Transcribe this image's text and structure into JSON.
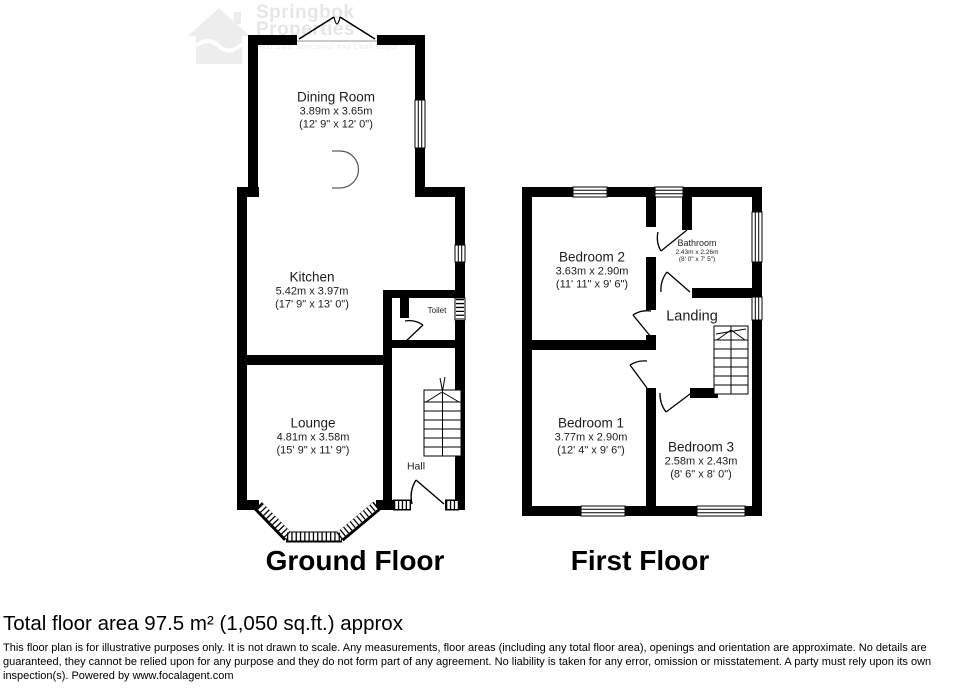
{
  "watermark": {
    "line1": "Springbok",
    "line2": "Properties",
    "tagline": "Fast Sale Specialist and Cash Buyer"
  },
  "ground_floor": {
    "title": "Ground Floor",
    "rooms": {
      "dining": {
        "name": "Dining Room",
        "metric": "3.89m x 3.65m",
        "imperial": "(12' 9\" x 12' 0\")"
      },
      "kitchen": {
        "name": "Kitchen",
        "metric": "5.42m x 3.97m",
        "imperial": "(17' 9\" x 13' 0\")"
      },
      "lounge": {
        "name": "Lounge",
        "metric": "4.81m x 3.58m",
        "imperial": "(15' 9\" x 11' 9\")"
      },
      "toilet": {
        "name": "Toilet"
      },
      "hall": {
        "name": "Hall"
      }
    }
  },
  "first_floor": {
    "title": "First Floor",
    "rooms": {
      "bedroom2": {
        "name": "Bedroom 2",
        "metric": "3.63m x 2.90m",
        "imperial": "(11' 11\" x 9' 6\")"
      },
      "bathroom": {
        "name": "Bathroom",
        "metric": "2.43m x 2.26m",
        "imperial": "(8' 0\" x 7' 5\")"
      },
      "landing": {
        "name": "Landing"
      },
      "bedroom1": {
        "name": "Bedroom 1",
        "metric": "3.77m x 2.90m",
        "imperial": "(12' 4\" x 9' 6\")"
      },
      "bedroom3": {
        "name": "Bedroom 3",
        "metric": "2.58m x 2.43m",
        "imperial": "(8' 6\" x 8' 0\")"
      }
    }
  },
  "footer": {
    "total_area": "Total floor area 97.5 m² (1,050 sq.ft.) approx",
    "disclaimer": "This floor plan is for illustrative purposes only. It is not drawn to scale. Any measurements, floor areas (including any total floor area), openings and orientation are approximate. No details are guaranteed, they cannot be relied upon for any purpose and they do not form part of any agreement. No liability is taken for any error, omission or misstatement. A party must rely upon its own inspection(s). Powered by www.focalagent.com"
  },
  "colors": {
    "wall": "#000000",
    "text": "#1c1c1c",
    "watermark": "#d2d2d2"
  }
}
